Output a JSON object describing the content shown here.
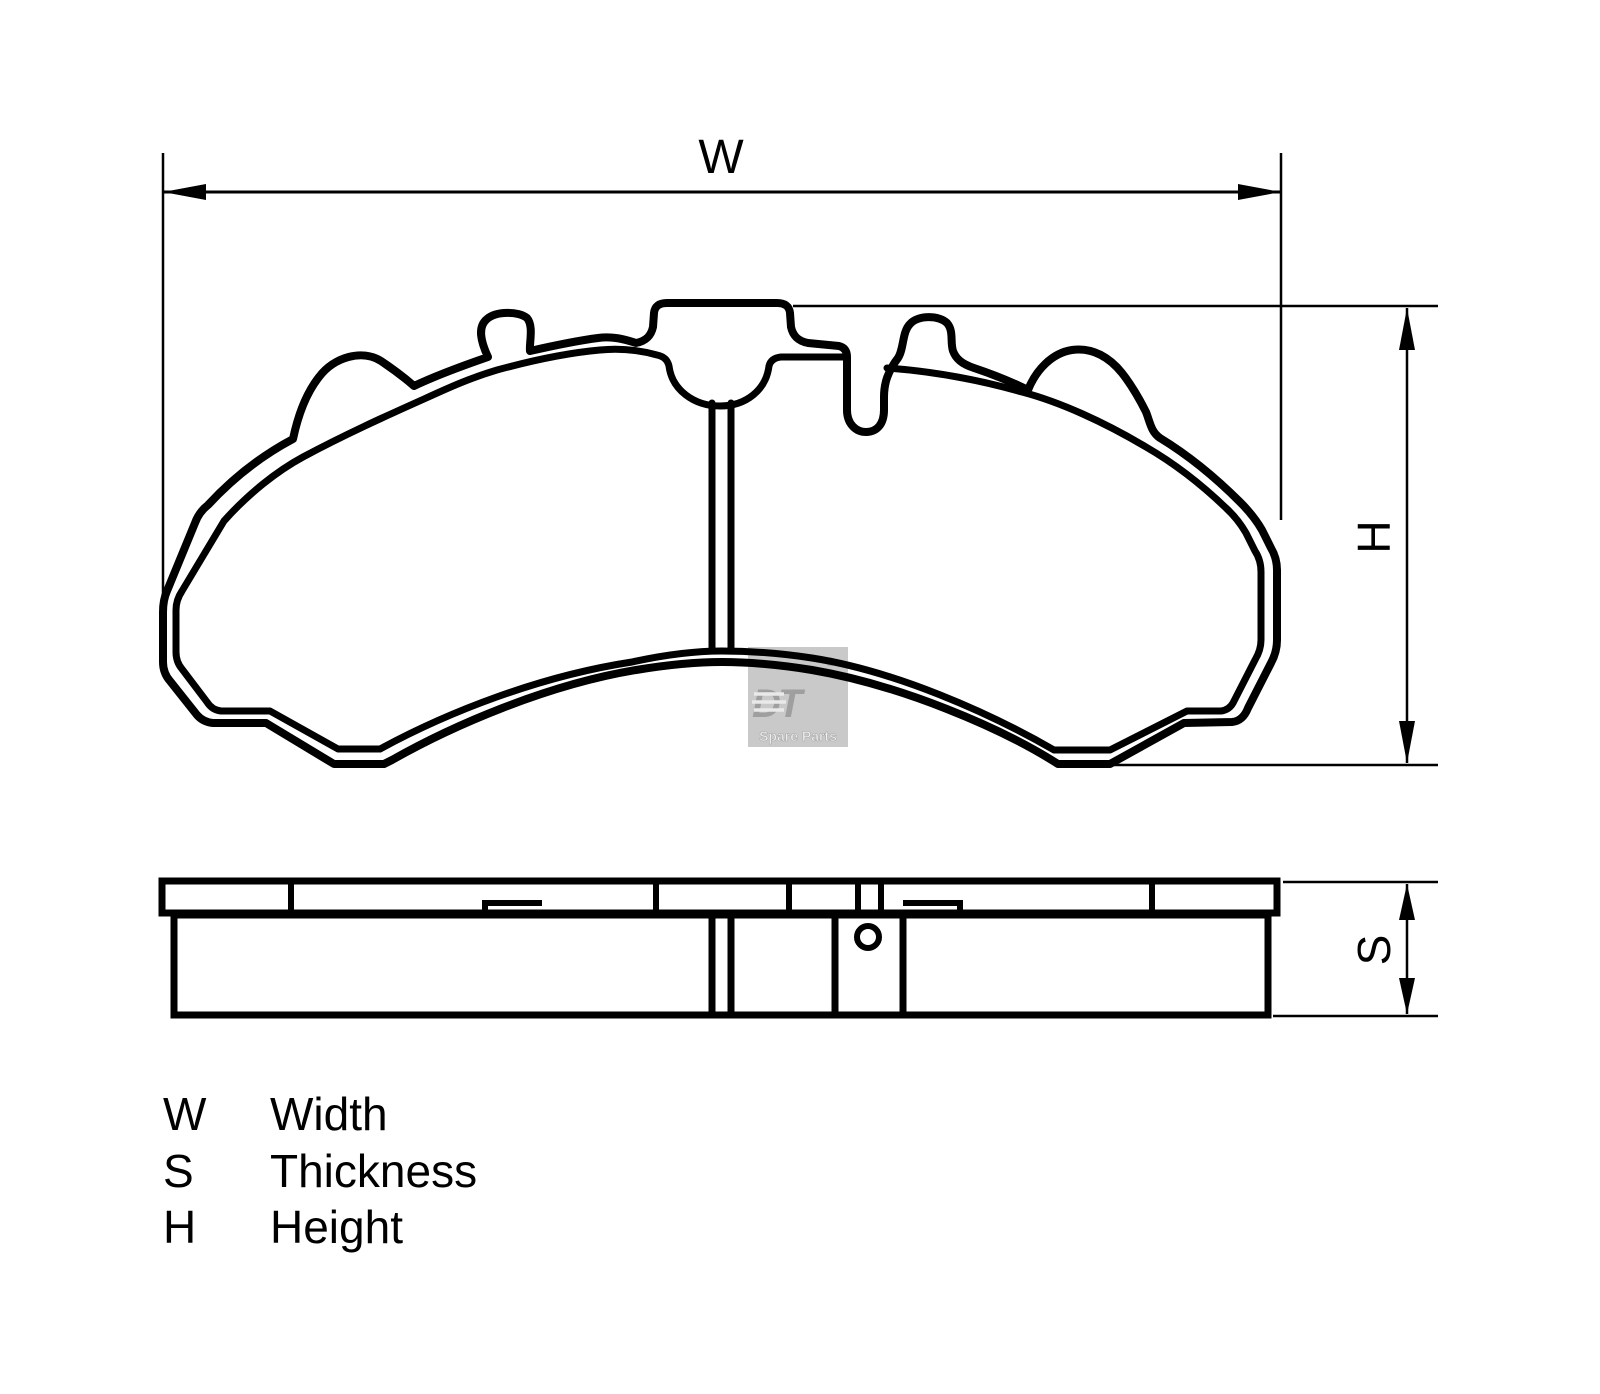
{
  "dimensions": {
    "width_label": "W",
    "height_label": "H",
    "thickness_label": "S"
  },
  "legend": {
    "rows": [
      {
        "symbol": "W",
        "label": "Width"
      },
      {
        "symbol": "S",
        "label": "Thickness"
      },
      {
        "symbol": "H",
        "label": "Height"
      }
    ]
  },
  "watermark": {
    "brand": "DT",
    "registered": "®",
    "tagline": "Spare Parts"
  },
  "colors": {
    "line": "#000000",
    "watermark_box": "#c9c9c9",
    "watermark_gray": "#9f9f9f",
    "watermark_text": "#efefef"
  }
}
